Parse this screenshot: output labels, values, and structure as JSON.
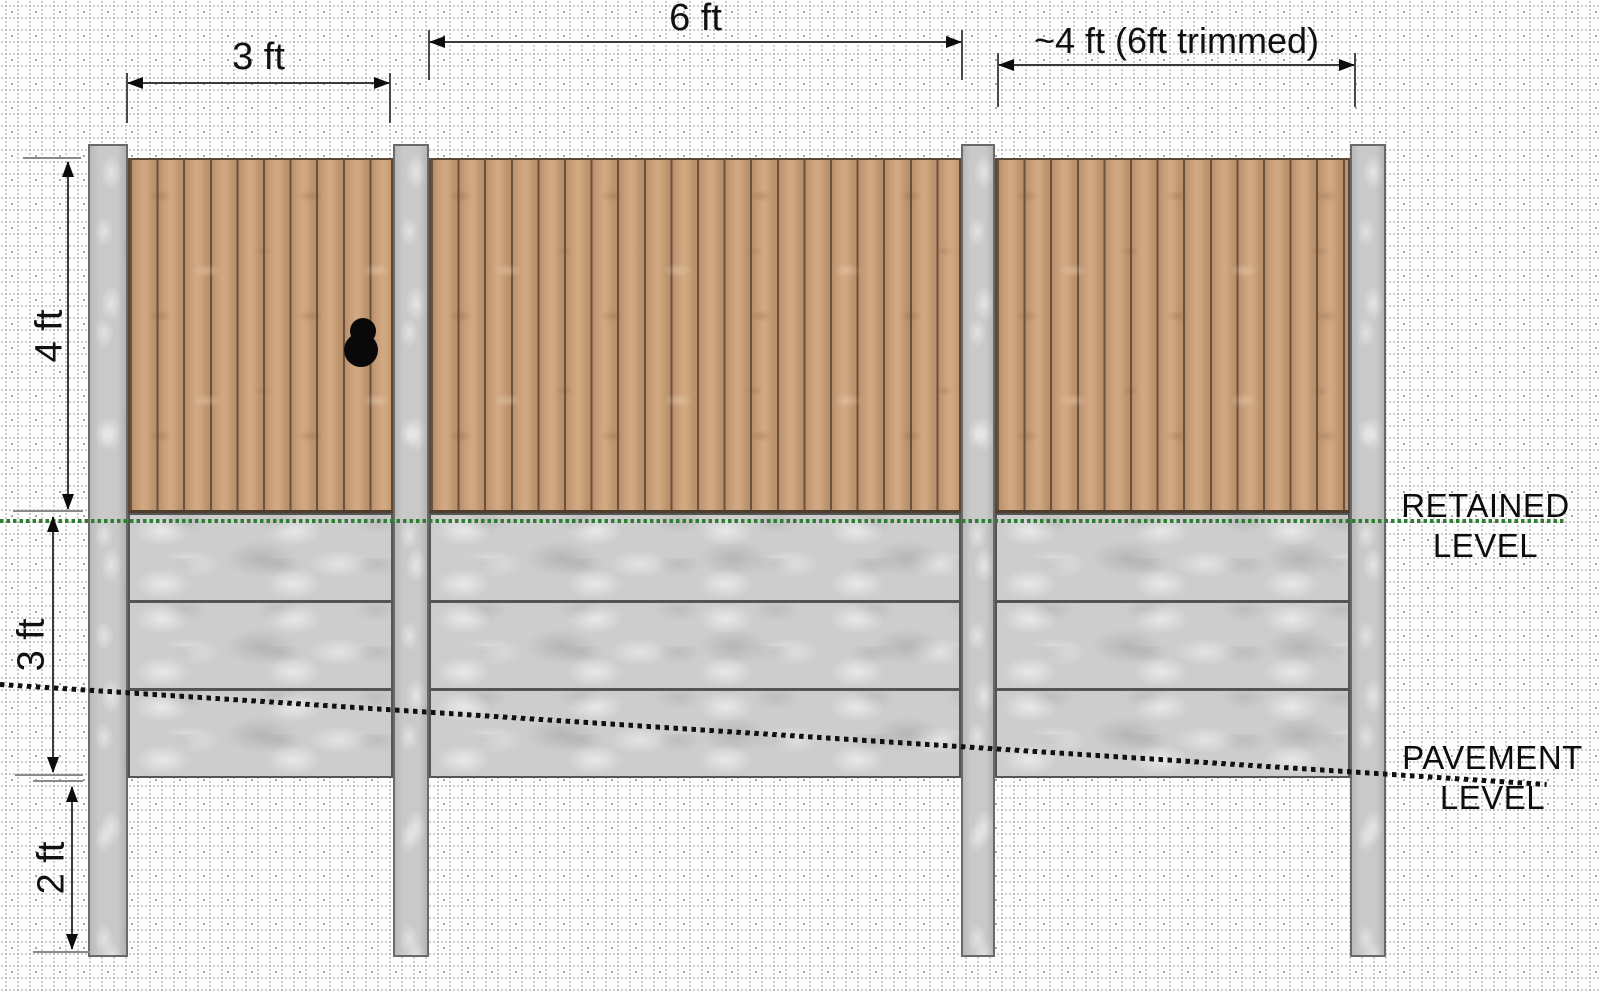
{
  "dimensions": {
    "top": [
      {
        "name": "bay-1-width",
        "label": "3 ft"
      },
      {
        "name": "bay-2-width",
        "label": "6 ft"
      },
      {
        "name": "bay-3-width",
        "label": "~4 ft (6ft trimmed)"
      }
    ],
    "left": [
      {
        "name": "panel-height",
        "label": "4 ft"
      },
      {
        "name": "retained-height",
        "label": "3 ft"
      },
      {
        "name": "buried-depth",
        "label": "2 ft"
      }
    ]
  },
  "levels": {
    "retained": {
      "line1": "RETAINED",
      "line2": "LEVEL",
      "color": "#2e7d32"
    },
    "pavement": {
      "line1": "PAVEMENT",
      "line2": "LEVEL",
      "color": "#111111"
    }
  },
  "colors": {
    "wood": "#c89e7a",
    "wood_gap": "#6b523c",
    "concrete_board": "#cdcdcd",
    "post": "#c9c9c9",
    "grid_dot": "#a8a8a8",
    "dimension_line": "#3a3a3a"
  },
  "structure": {
    "posts": 4,
    "bays": 3,
    "gravel_boards_per_bay": 3
  }
}
